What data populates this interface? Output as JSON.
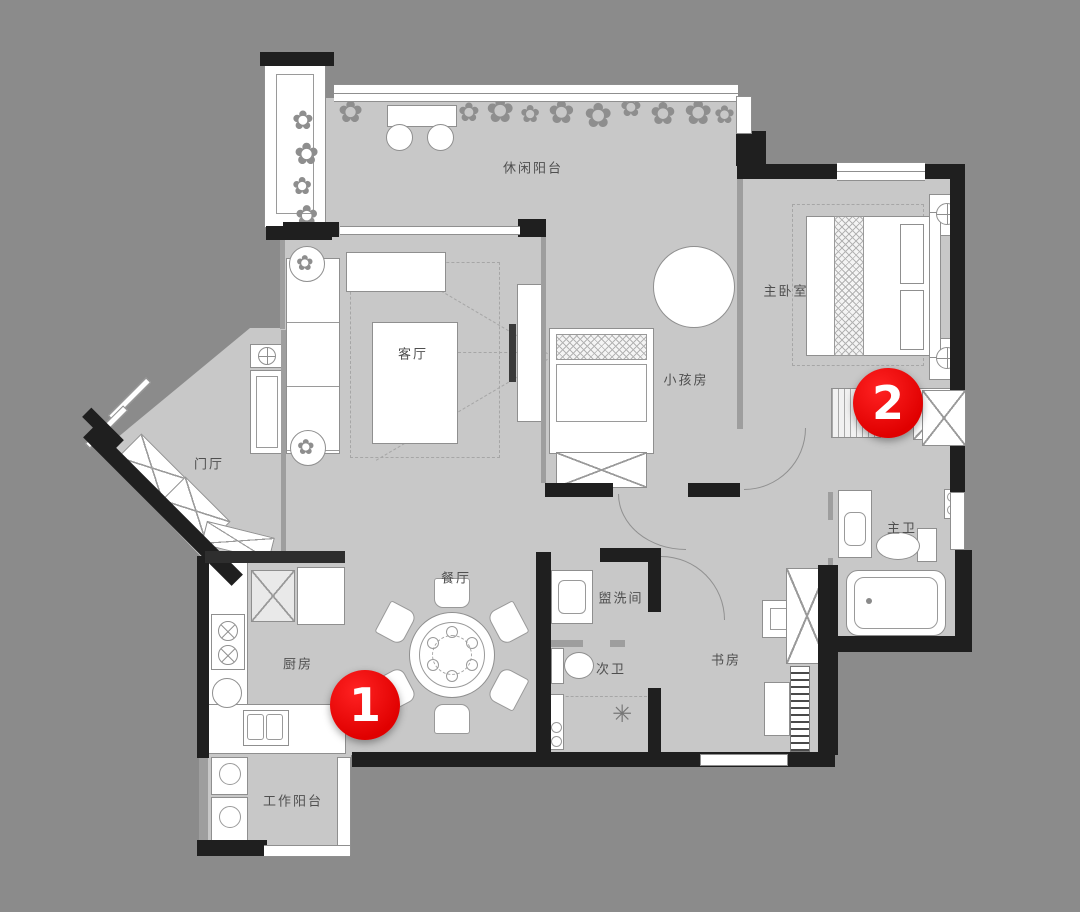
{
  "title": "apartment-floor-plan",
  "colors": {
    "background": "#8b8b8b",
    "floor": "#c8c8c8",
    "wall": "#1f1f1f",
    "furniture_outline": "#8f8f8f",
    "marker_red": "#e00000",
    "label_text": "#4f4f4f"
  },
  "rooms": [
    {
      "id": "leisure-balcony",
      "label": "休闲阳台"
    },
    {
      "id": "living-room",
      "label": "客厅"
    },
    {
      "id": "kids-room",
      "label": "小孩房"
    },
    {
      "id": "master-bedroom",
      "label": "主卧室"
    },
    {
      "id": "foyer",
      "label": "门厅"
    },
    {
      "id": "dining-room",
      "label": "餐厅"
    },
    {
      "id": "kitchen",
      "label": "厨房"
    },
    {
      "id": "washroom",
      "label": "盥洗间"
    },
    {
      "id": "second-bathroom",
      "label": "次卫"
    },
    {
      "id": "study",
      "label": "书房"
    },
    {
      "id": "master-bathroom",
      "label": "主卫"
    },
    {
      "id": "work-balcony",
      "label": "工作阳台"
    }
  ],
  "markers": [
    {
      "number": "1"
    },
    {
      "number": "2"
    }
  ],
  "icons": {
    "plant_glyph": "✿",
    "shower_glyph": "✳"
  }
}
